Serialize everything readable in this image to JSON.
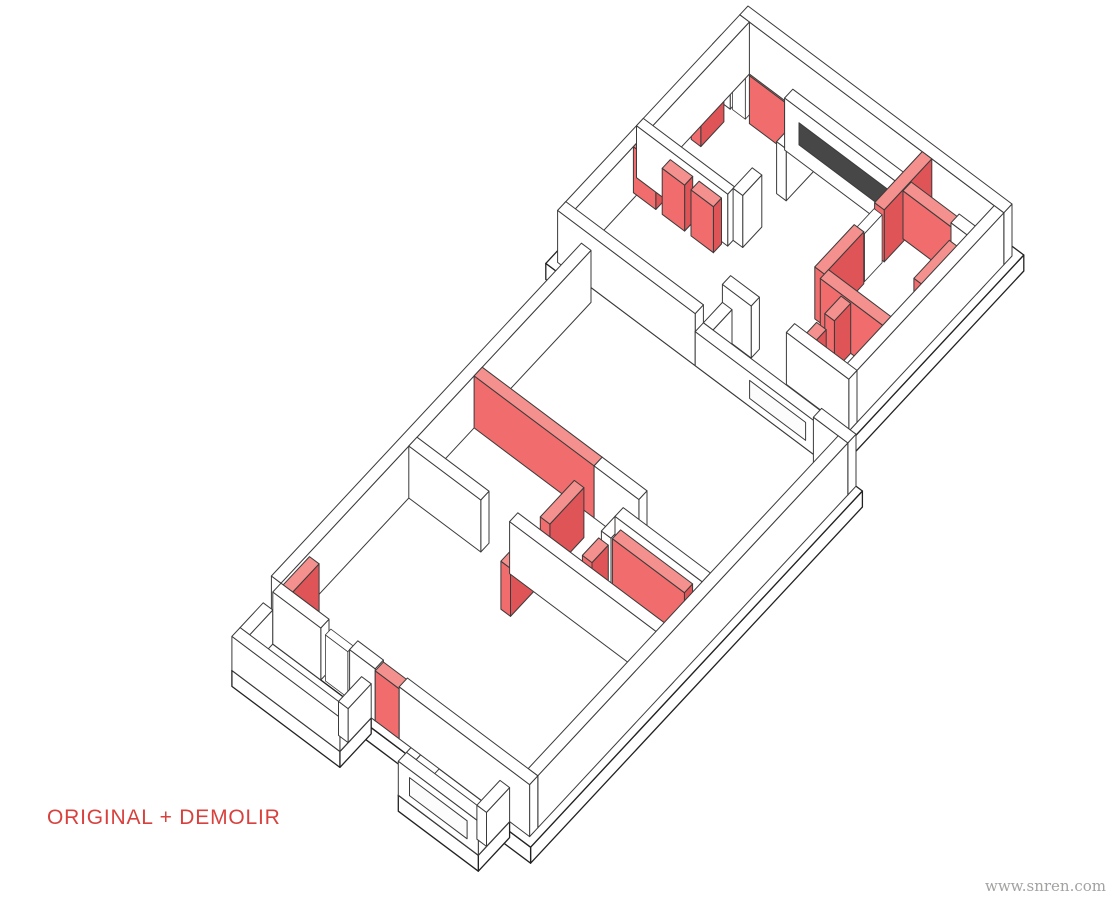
{
  "title_label": "ORIGINAL + DEMOLIR",
  "watermark": "www.snren.com",
  "colors": {
    "background": "#ffffff",
    "label_red": "#d8413e",
    "watermark_gray": "#a3a2a0",
    "line": "#3b3b3b",
    "slab_line": "#222222",
    "wall_white": "#ffffff",
    "red_top": "#f4908d",
    "red_side": "#f06c6d",
    "red_side_dark": "#de5457",
    "slot_dark": "#474747",
    "slot_light": "#fcfcfc"
  },
  "axon": {
    "projection": {
      "A": [
        0.8,
        0.6
      ],
      "B": [
        -0.68,
        0.73
      ],
      "origin": [
        748,
        58
      ],
      "wall_height": 52,
      "parapet_height": 34,
      "slab_thickness": 16
    },
    "slabs": [
      {
        "id": "upper-block-slab",
        "x": -8,
        "y": -8,
        "w": 346,
        "d": 296
      },
      {
        "id": "lower-block-slab",
        "x": 32,
        "y": 280,
        "w": 349,
        "d": 488
      },
      {
        "id": "balcony-left-slab",
        "x": 40,
        "y": 760,
        "w": 135,
        "d": 46
      },
      {
        "id": "balcony-right-slab",
        "x": 248,
        "y": 760,
        "w": 100,
        "d": 46
      }
    ],
    "walls": [
      {
        "id": "a-outer-top",
        "x": 0,
        "y": 0,
        "w": 330,
        "d": 12,
        "h": 52,
        "color": "white"
      },
      {
        "id": "a-right-perimeter",
        "x": 318,
        "y": 12,
        "w": 12,
        "d": 268,
        "h": 52,
        "color": "white"
      },
      {
        "id": "a-left-perimeter",
        "x": 0,
        "y": 12,
        "w": 12,
        "d": 258,
        "h": 52,
        "color": "white"
      },
      {
        "id": "a-strip-inner-left",
        "x": 0,
        "y": 40,
        "w": 22,
        "d": 12,
        "h": 52,
        "color": "white"
      },
      {
        "id": "a-strip-door-frame",
        "x": 24,
        "y": 41,
        "w": 16,
        "d": 10,
        "h": 48,
        "color": "frame"
      },
      {
        "id": "a-strip-red-1",
        "x": 46,
        "y": 40,
        "w": 44,
        "d": 12,
        "h": 48,
        "color": "red"
      },
      {
        "id": "a-strip-inner-mid",
        "x": 90,
        "y": 40,
        "w": 148,
        "d": 12,
        "h": 52,
        "color": "white",
        "slot": [
          108,
          230
        ],
        "slotStyle": "dark",
        "slotZ": [
          16,
          38
        ]
      },
      {
        "id": "a-strip-red-2",
        "x": 238,
        "y": 40,
        "w": 60,
        "d": 12,
        "h": 48,
        "color": "red"
      },
      {
        "id": "a-strip-inner-right",
        "x": 298,
        "y": 40,
        "w": 32,
        "d": 12,
        "h": 52,
        "color": "white"
      },
      {
        "id": "a-leftroom-divider-a",
        "x": 114,
        "y": 52,
        "w": 12,
        "d": 40,
        "h": 52,
        "color": "white"
      },
      {
        "id": "a-leftroom-divider-b",
        "x": 114,
        "y": 128,
        "w": 12,
        "d": 28,
        "h": 52,
        "color": "white"
      },
      {
        "id": "a-closet-back",
        "x": 0,
        "y": 154,
        "w": 114,
        "d": 10,
        "h": 52,
        "color": "white"
      },
      {
        "id": "a-closet-red-1",
        "x": 8,
        "y": 166,
        "w": 28,
        "d": 12,
        "h": 46,
        "color": "red"
      },
      {
        "id": "a-closet-red-2",
        "x": 44,
        "y": 166,
        "w": 28,
        "d": 12,
        "h": 46,
        "color": "red"
      },
      {
        "id": "a-closet-red-3",
        "x": 80,
        "y": 166,
        "w": 28,
        "d": 12,
        "h": 46,
        "color": "red"
      },
      {
        "id": "a-leftwall-red-stub",
        "x": 14,
        "y": 66,
        "w": 12,
        "d": 34,
        "h": 48,
        "color": "red"
      },
      {
        "id": "a-rightroom-red-upper",
        "x": 228,
        "y": 12,
        "w": 12,
        "d": 70,
        "h": 52,
        "color": "red"
      },
      {
        "id": "a-rightroom-door-frame",
        "x": 229,
        "y": 84,
        "w": 10,
        "d": 26,
        "h": 48,
        "color": "frame"
      },
      {
        "id": "a-rightroom-red-lower",
        "x": 228,
        "y": 112,
        "w": 12,
        "d": 58,
        "h": 52,
        "color": "red"
      },
      {
        "id": "a-rightroom-red-bottom",
        "x": 240,
        "y": 164,
        "w": 78,
        "d": 12,
        "h": 52,
        "color": "red"
      },
      {
        "id": "a-rightwall-red-panel",
        "x": 306,
        "y": 64,
        "w": 12,
        "d": 52,
        "h": 48,
        "color": "red"
      },
      {
        "id": "a-hall-red-a",
        "x": 266,
        "y": 176,
        "w": 12,
        "d": 24,
        "h": 50,
        "color": "red"
      },
      {
        "id": "a-hall-red-b",
        "x": 266,
        "y": 212,
        "w": 12,
        "d": 16,
        "h": 50,
        "color": "red"
      },
      {
        "id": "a-balc-inner-left",
        "x": 172,
        "y": 228,
        "w": 36,
        "d": 12,
        "h": 52,
        "color": "white"
      },
      {
        "id": "a-balc-inner-right",
        "x": 252,
        "y": 228,
        "w": 78,
        "d": 12,
        "h": 52,
        "color": "white"
      },
      {
        "id": "a-balc-parapet",
        "x": 172,
        "y": 268,
        "w": 158,
        "d": 12,
        "h": 34,
        "color": "white",
        "slot": [
          240,
          310
        ],
        "slotStyle": "light",
        "slotZ": [
          8,
          26
        ]
      },
      {
        "id": "a-balc-side",
        "x": 172,
        "y": 240,
        "w": 12,
        "d": 28,
        "h": 34,
        "color": "white"
      },
      {
        "id": "a-bottom-left-wall",
        "x": 0,
        "y": 268,
        "w": 172,
        "d": 12,
        "h": 52,
        "color": "white"
      },
      {
        "id": "b-left-perimeter",
        "x": 40,
        "y": 292,
        "w": 12,
        "d": 456,
        "h": 52,
        "color": "white"
      },
      {
        "id": "b-top-step",
        "x": 330,
        "y": 280,
        "w": 43,
        "d": 12,
        "h": 52,
        "color": "white"
      },
      {
        "id": "b-right-perimeter",
        "x": 361,
        "y": 292,
        "w": 12,
        "d": 456,
        "h": 52,
        "color": "white"
      },
      {
        "id": "b-demolish-main-wall",
        "x": 52,
        "y": 452,
        "w": 150,
        "d": 12,
        "h": 52,
        "color": "red"
      },
      {
        "id": "b-mid-white-wall",
        "x": 202,
        "y": 452,
        "w": 56,
        "d": 12,
        "h": 52,
        "color": "white"
      },
      {
        "id": "b-hall-red-stub",
        "x": 196,
        "y": 486,
        "w": 12,
        "d": 50,
        "h": 50,
        "color": "red"
      },
      {
        "id": "bath-top-wall",
        "x": 252,
        "y": 480,
        "w": 109,
        "d": 12,
        "h": 52,
        "color": "white"
      },
      {
        "id": "bath-left-wall",
        "x": 252,
        "y": 492,
        "w": 12,
        "d": 20,
        "h": 52,
        "color": "white"
      },
      {
        "id": "bath-red-door-panel",
        "x": 252,
        "y": 516,
        "w": 12,
        "d": 24,
        "h": 48,
        "color": "red"
      },
      {
        "id": "bath-red-inner-wall",
        "x": 264,
        "y": 498,
        "w": 90,
        "d": 12,
        "h": 50,
        "color": "red"
      },
      {
        "id": "bedroom-divider-left",
        "x": 52,
        "y": 548,
        "w": 90,
        "d": 12,
        "h": 52,
        "color": "white"
      },
      {
        "id": "bedroom-divider-right",
        "x": 178,
        "y": 548,
        "w": 195,
        "d": 12,
        "h": 52,
        "color": "white"
      },
      {
        "id": "bedroom-divider-red-panel",
        "x": 196,
        "y": 560,
        "w": 12,
        "d": 34,
        "h": 48,
        "color": "red"
      },
      {
        "id": "b-end-red-stub",
        "x": 52,
        "y": 706,
        "w": 12,
        "d": 40,
        "h": 48,
        "color": "red"
      },
      {
        "id": "b-end-wall-left",
        "x": 52,
        "y": 748,
        "w": 60,
        "d": 12,
        "h": 52,
        "color": "white"
      },
      {
        "id": "b-end-door-frame",
        "x": 116,
        "y": 750,
        "w": 28,
        "d": 8,
        "h": 46,
        "color": "frame"
      },
      {
        "id": "b-end-wall-mid",
        "x": 148,
        "y": 748,
        "w": 32,
        "d": 12,
        "h": 52,
        "color": "white"
      },
      {
        "id": "b-end-red-segment",
        "x": 180,
        "y": 748,
        "w": 30,
        "d": 12,
        "h": 50,
        "color": "red"
      },
      {
        "id": "b-end-wall-right",
        "x": 210,
        "y": 748,
        "w": 163,
        "d": 12,
        "h": 52,
        "color": "white"
      },
      {
        "id": "balcony-left-parapet",
        "x": 40,
        "y": 794,
        "w": 135,
        "d": 12,
        "h": 34,
        "color": "white"
      },
      {
        "id": "balcony-left-side-a",
        "x": 40,
        "y": 760,
        "w": 12,
        "d": 34,
        "h": 34,
        "color": "white"
      },
      {
        "id": "balcony-left-side-b",
        "x": 163,
        "y": 760,
        "w": 12,
        "d": 34,
        "h": 34,
        "color": "white"
      },
      {
        "id": "balcony-right-parapet",
        "x": 248,
        "y": 794,
        "w": 100,
        "d": 12,
        "h": 34,
        "color": "white",
        "slot": [
          262,
          334
        ],
        "slotStyle": "light",
        "slotZ": [
          8,
          26
        ]
      },
      {
        "id": "balcony-right-side-a",
        "x": 248,
        "y": 760,
        "w": 12,
        "d": 34,
        "h": 34,
        "color": "white"
      },
      {
        "id": "balcony-right-side-b",
        "x": 336,
        "y": 760,
        "w": 12,
        "d": 34,
        "h": 34,
        "color": "white"
      }
    ]
  }
}
